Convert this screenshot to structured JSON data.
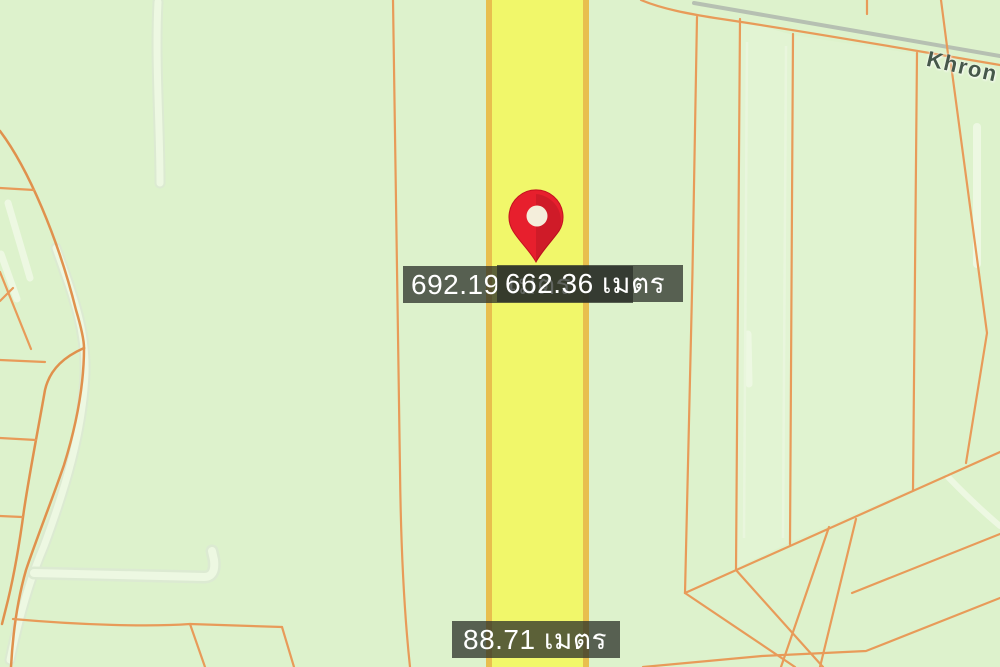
{
  "map": {
    "description": "parcel map with distance measurements",
    "road_name_label": "Khron",
    "marker": {
      "icon": "map-pin",
      "color": "#e71f2d"
    },
    "measurements": [
      {
        "value": "692.19",
        "unit": "เมตร",
        "text": "692.19 เมตร"
      },
      {
        "value": "662.36",
        "unit": "เมตร",
        "text": "662.36 เมตร"
      },
      {
        "value": "88.71",
        "unit": "เมตร",
        "text": "88.71 เมตร"
      }
    ]
  },
  "colors": {
    "map-bg": "#ddf2cc",
    "parcel-line": "#e89b59",
    "road-fill": "#f1f76a",
    "road-border": "#e8bf4e",
    "stream": "#edf8e2",
    "stream-edge": "#dcead2",
    "gray-road": "#b6c0b2",
    "label-bg": "rgba(42,47,40,0.75)",
    "label-text": "#ffffff",
    "road-name-text": "#46584a",
    "pin-red": "#e71f2d",
    "pin-hole": "#f4eedb",
    "parcel-light": "#e6f6d8"
  }
}
